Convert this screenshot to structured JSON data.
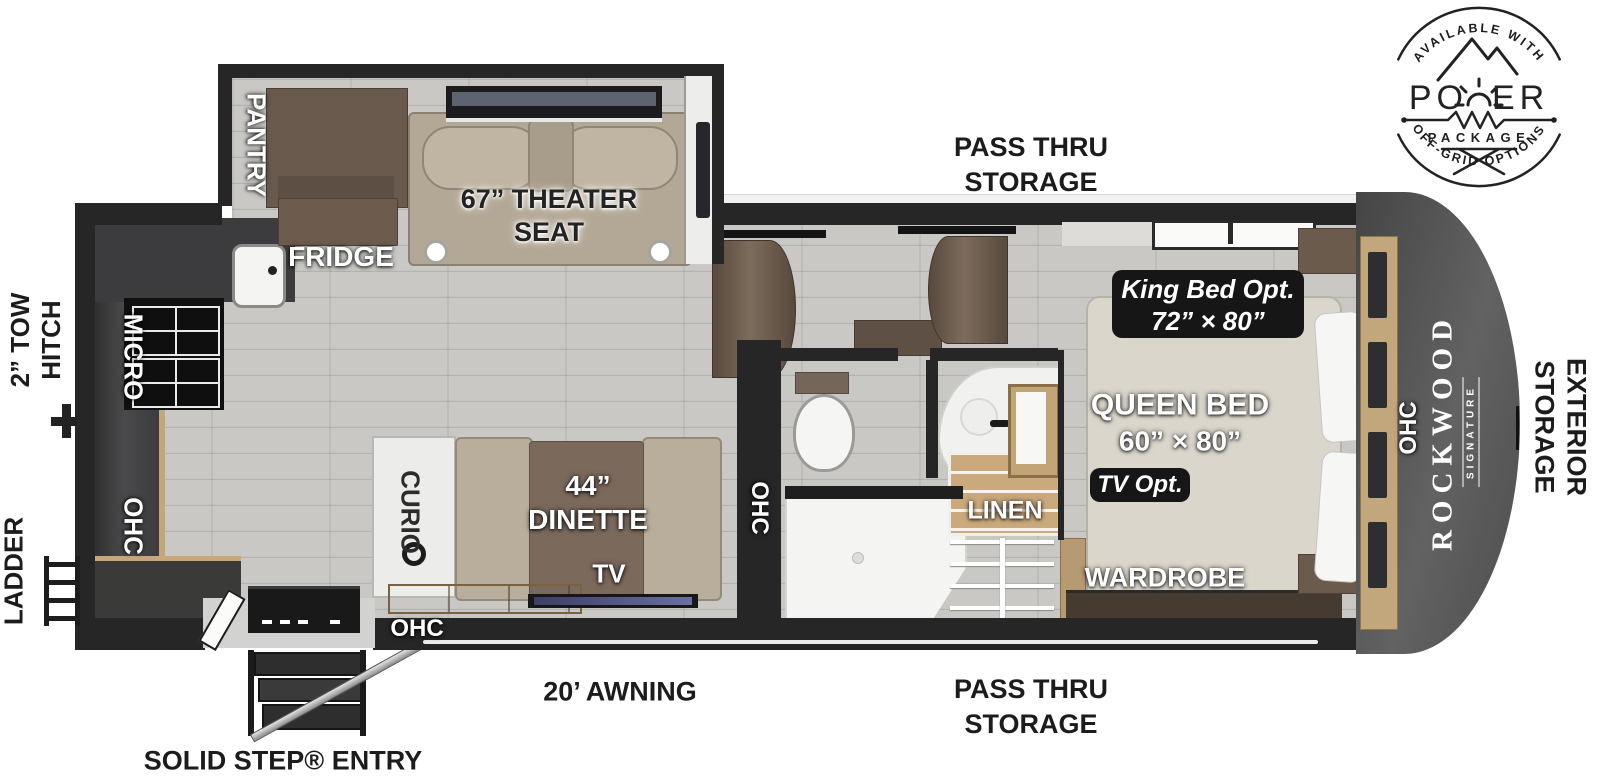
{
  "power_badge": {
    "available_with": "AVAILABLE WITH",
    "power_left": "PO",
    "power_right": "ER",
    "package": "PACKAGE",
    "off_grid": "OFF-GRID OPTIONS"
  },
  "exterior": {
    "pass_thru_top": {
      "line1": "PASS THRU",
      "line2": "STORAGE"
    },
    "tow_hitch": {
      "line1": "2” TOW",
      "line2": "HITCH"
    },
    "ladder": "LADDER",
    "awning": "20’ AWNING",
    "pass_thru_bottom": {
      "line1": "PASS THRU",
      "line2": "STORAGE"
    },
    "solid_step_entry": "SOLID STEP® ENTRY",
    "exterior_storage": {
      "line1": "EXTERIOR",
      "line2": "STORAGE"
    }
  },
  "slide_out": {
    "pantry": "PANTRY",
    "theater_seat": {
      "line1": "67” THEATER",
      "line2": "SEAT"
    }
  },
  "kitchen": {
    "fridge": "FRIDGE",
    "micro": "MICRO",
    "ohc": "OHC"
  },
  "living_area": {
    "curio": "CURIO",
    "dinette": {
      "line1": "44”",
      "line2": "DINETTE"
    },
    "tv": "TV",
    "ohc_lower": "OHC",
    "ohc_wall": "OHC"
  },
  "bathroom": {
    "linen": "LINEN"
  },
  "bedroom": {
    "king_bed_option": {
      "line1": "King Bed Opt.",
      "line2": "72” × 80”"
    },
    "queen_bed": {
      "line1": "QUEEN BED",
      "line2": "60” × 80”"
    },
    "tv_option": "TV Opt.",
    "wardrobe": "WARDROBE",
    "ohc": "OHC"
  },
  "front_cap": {
    "brand": "ROCKWOOD",
    "series": "SIGNATURE",
    "ohc": "OHC"
  },
  "colors": {
    "wall": "#262626",
    "floor": "#c9c8c4",
    "wood_accent": "#c2a77c",
    "cabinet_brown": "#6b5a4c",
    "seat_tan": "#b3a896",
    "badge_black": "#161616",
    "cap_gray": "#545454"
  }
}
